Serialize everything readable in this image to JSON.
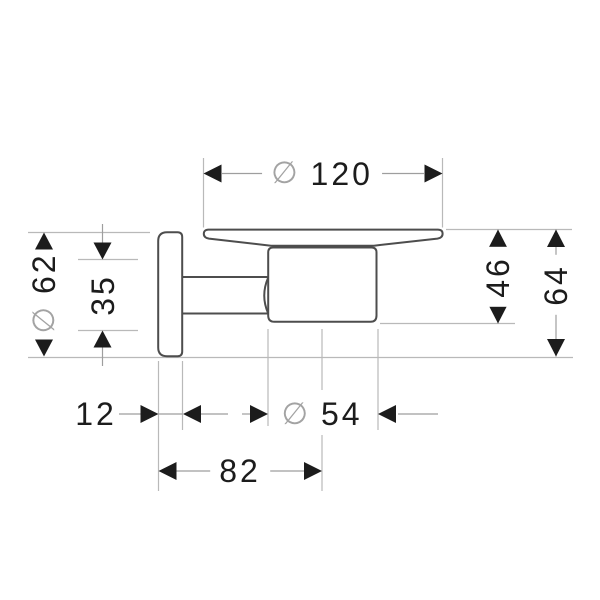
{
  "drawing": {
    "title": "wall-mounted soap dish holder - side view technical drawing",
    "colors": {
      "background": "#ffffff",
      "product_outline": "#4d4d4d",
      "dimension_text": "#1c1c1c",
      "arrow": "#1c1c1c",
      "dimension_line": "#9e9e9e",
      "extension_line": "#b9b9b9",
      "diameter_symbol": "#a3a3a3"
    },
    "dimensions": {
      "dish_diameter": {
        "symbol": "∅",
        "value": "120"
      },
      "plate_diameter": {
        "symbol": "∅",
        "value": "62"
      },
      "plate_inner": {
        "value": "35"
      },
      "cup_drop_height": {
        "value": "46"
      },
      "overall_height": {
        "value": "64"
      },
      "plate_depth": {
        "value": "12"
      },
      "cup_diameter": {
        "symbol": "∅",
        "value": "54"
      },
      "overall_depth": {
        "value": "82"
      }
    }
  }
}
